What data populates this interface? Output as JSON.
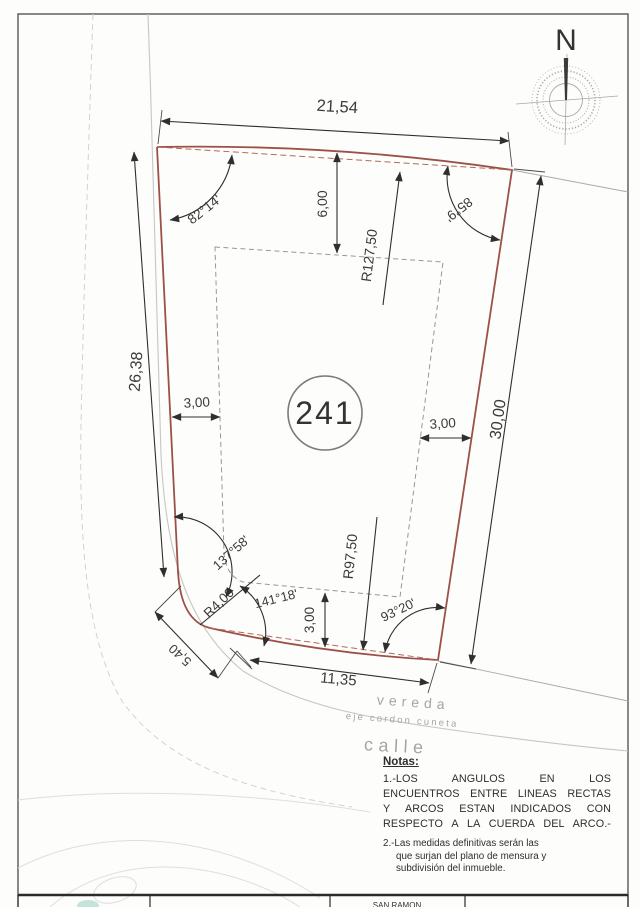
{
  "drawing": {
    "north_label": "N",
    "lot_number": "241",
    "dims": {
      "top": "21,54",
      "left": "26,38",
      "right": "30,00",
      "bottom": "11,35",
      "corner": "5,40",
      "front_setback": "6,00",
      "left_setback": "3,00",
      "right_setback": "3,00",
      "rear_setback": "3,00",
      "top_radius": "R127,50",
      "bottom_radius": "R97,50",
      "corner_radius": "R4,00"
    },
    "angles": {
      "top_left": "82°14'",
      "top_right": "85°9'",
      "left_corner": "137°58'",
      "bottom_corner": "141°18'",
      "bottom_right": "93°20'"
    },
    "streets": {
      "vereda": "vereda",
      "eje": "eje cordon cuneta",
      "calle": "calle"
    },
    "notes": {
      "title": "Notas:",
      "n1": [
        "1.-LOS ANGULOS EN LOS",
        "ENCUENTROS ENTRE LINEAS RECTAS",
        "Y ARCOS ESTAN INDICADOS CON",
        "RESPECTO A LA CUERDA DEL ARCO.-"
      ],
      "n2": [
        "2.-Las medidas definitivas serán las",
        "que surjan del plano de mensura y",
        "subdivisión del inmueble."
      ]
    },
    "titleblock": {
      "text": "SAN RAMON"
    }
  }
}
